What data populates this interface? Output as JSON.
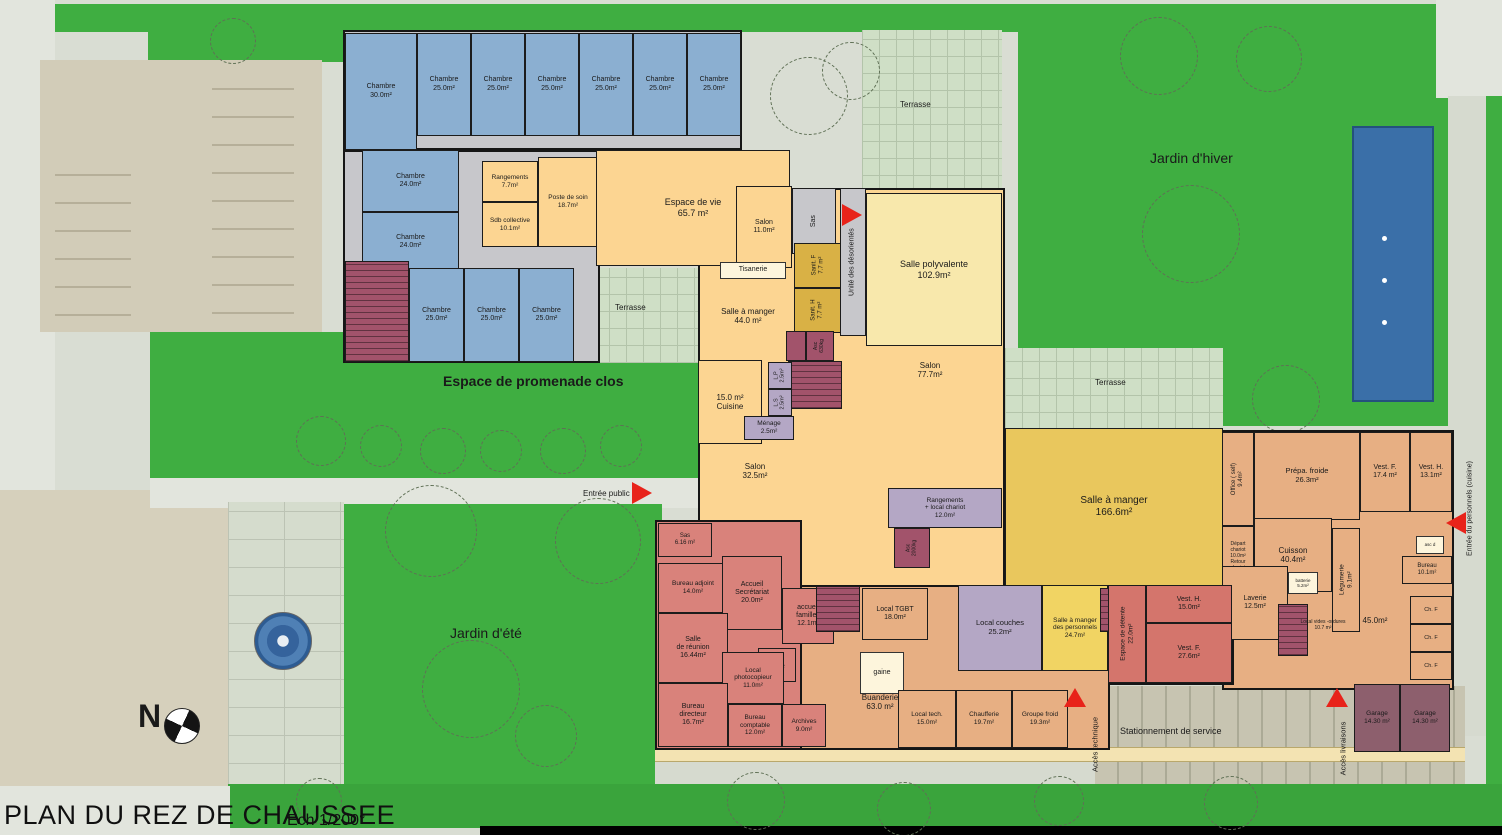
{
  "title": {
    "main": "PLAN DU REZ DE CHAUSSEE",
    "scale": "Ech 1/200°"
  },
  "compass_label": "N",
  "site": {
    "terrasse_top": "Terrasse",
    "jardin_hiver": "Jardin d'hiver",
    "terrasse_north": "Terrasse",
    "espace_promenade": "Espace de promenade clos",
    "entree_public": "Entrée public",
    "jardin_ete": "Jardin d'été",
    "terrasse_mid": "Terrasse",
    "stationnement": "Stationnement de service",
    "acces_technique": "Accès technique",
    "acces_livraisons": "Accès livraisons",
    "entree_personnel": "Entrée du personnels (cuisine)"
  },
  "rooms": [
    {
      "l": "Chambre\n30.0m²",
      "x": 345,
      "y": 33,
      "w": 72,
      "h": 117,
      "c": "blue",
      "fs": 7
    },
    {
      "l": "Chambre\n25.0m²",
      "x": 417,
      "y": 33,
      "w": 54,
      "h": 103,
      "c": "blue",
      "fs": 7
    },
    {
      "l": "Chambre\n25.0m²",
      "x": 471,
      "y": 33,
      "w": 54,
      "h": 103,
      "c": "blue",
      "fs": 7
    },
    {
      "l": "Chambre\n25.0m²",
      "x": 525,
      "y": 33,
      "w": 54,
      "h": 103,
      "c": "blue",
      "fs": 7
    },
    {
      "l": "Chambre\n25.0m²",
      "x": 579,
      "y": 33,
      "w": 54,
      "h": 103,
      "c": "blue",
      "fs": 7
    },
    {
      "l": "Chambre\n25.0m²",
      "x": 633,
      "y": 33,
      "w": 54,
      "h": 103,
      "c": "blue",
      "fs": 7
    },
    {
      "l": "Chambre\n25.0m²",
      "x": 687,
      "y": 33,
      "w": 54,
      "h": 103,
      "c": "blue",
      "fs": 7
    },
    {
      "l": "Chambre\n24.0m²",
      "x": 362,
      "y": 150,
      "w": 97,
      "h": 62,
      "c": "blue",
      "fs": 7
    },
    {
      "l": "Chambre\n24.0m²",
      "x": 362,
      "y": 212,
      "w": 97,
      "h": 60,
      "c": "blue",
      "fs": 7
    },
    {
      "l": "",
      "x": 345,
      "y": 261,
      "w": 64,
      "h": 101,
      "c": "maroonstair"
    },
    {
      "l": "Chambre\n25.0m²",
      "x": 409,
      "y": 268,
      "w": 55,
      "h": 94,
      "c": "blue",
      "fs": 7
    },
    {
      "l": "Chambre\n25.0m²",
      "x": 464,
      "y": 268,
      "w": 55,
      "h": 94,
      "c": "blue",
      "fs": 7
    },
    {
      "l": "Chambre\n25.0m²",
      "x": 519,
      "y": 268,
      "w": 55,
      "h": 94,
      "c": "blue",
      "fs": 7
    },
    {
      "l": "Rangements\n7.7m²",
      "x": 482,
      "y": 161,
      "w": 56,
      "h": 41,
      "c": "orange",
      "fs": 6.5
    },
    {
      "l": "Sdb collective\n10.1m²",
      "x": 482,
      "y": 202,
      "w": 56,
      "h": 45,
      "c": "orange",
      "fs": 6.5
    },
    {
      "l": "Poste de soin\n18.7m²",
      "x": 538,
      "y": 157,
      "w": 60,
      "h": 90,
      "c": "orange",
      "fs": 6.5
    },
    {
      "l": "Espace de vie\n65.7 m²",
      "x": 596,
      "y": 150,
      "w": 194,
      "h": 116,
      "c": "orange",
      "fs": 9
    },
    {
      "l": "Salon\n11.0m²",
      "x": 736,
      "y": 186,
      "w": 56,
      "h": 82,
      "c": "orange",
      "fs": 7
    },
    {
      "l": "Sas",
      "x": 792,
      "y": 188,
      "w": 44,
      "h": 66,
      "c": "grey",
      "rot": 1,
      "fs": 7
    },
    {
      "l": "Sanit. F\n7.7 m²",
      "x": 794,
      "y": 243,
      "w": 48,
      "h": 45,
      "c": "sanit",
      "rot": 1,
      "fs": 6
    },
    {
      "l": "Sanit. H\n7.7 m²",
      "x": 794,
      "y": 288,
      "w": 48,
      "h": 45,
      "c": "sanit",
      "rot": 1,
      "fs": 6
    },
    {
      "l": "Unité des désorientés",
      "x": 840,
      "y": 188,
      "w": 26,
      "h": 148,
      "c": "grey",
      "rot": 1,
      "fs": 7
    },
    {
      "l": "Salle polyvalente\n102.9m²",
      "x": 866,
      "y": 193,
      "w": 136,
      "h": 153,
      "c": "paleyellow",
      "fs": 9
    },
    {
      "l": "Tisanerie",
      "x": 720,
      "y": 262,
      "w": 66,
      "h": 17,
      "c": "box",
      "fs": 7
    },
    {
      "l": "Salle à manger\n44.0 m²",
      "x": 692,
      "y": 296,
      "w": 112,
      "h": 40,
      "c": "none",
      "fs": 8
    },
    {
      "l": "",
      "x": 786,
      "y": 331,
      "w": 20,
      "h": 30,
      "c": "maroon"
    },
    {
      "l": "Asc\n630kg",
      "x": 806,
      "y": 331,
      "w": 28,
      "h": 30,
      "c": "maroon",
      "rot": 1,
      "fs": 5
    },
    {
      "l": "",
      "x": 788,
      "y": 361,
      "w": 54,
      "h": 48,
      "c": "maroonstair"
    },
    {
      "l": "15.0 m²\nCuisine",
      "x": 698,
      "y": 360,
      "w": 64,
      "h": 84,
      "c": "orange",
      "fs": 8
    },
    {
      "l": "L.P\n2.5m²",
      "x": 768,
      "y": 362,
      "w": 24,
      "h": 27,
      "c": "lav",
      "rot": 1,
      "fs": 5.5
    },
    {
      "l": "L.S\n2.5m²",
      "x": 768,
      "y": 389,
      "w": 24,
      "h": 27,
      "c": "lav",
      "rot": 1,
      "fs": 5.5
    },
    {
      "l": "Ménage\n2.5m²",
      "x": 744,
      "y": 416,
      "w": 50,
      "h": 24,
      "c": "lav",
      "fs": 6.5
    },
    {
      "l": "Salon\n32.5m²",
      "x": 718,
      "y": 455,
      "w": 74,
      "h": 32,
      "c": "none",
      "fs": 8
    },
    {
      "l": "Salon\n77.7m²",
      "x": 890,
      "y": 352,
      "w": 80,
      "h": 36,
      "c": "none",
      "fs": 8
    },
    {
      "l": "Rangements\n+ local chariot\n12.0m²",
      "x": 888,
      "y": 488,
      "w": 114,
      "h": 40,
      "c": "lav",
      "fs": 6.5
    },
    {
      "l": "Asc\n2000kg",
      "x": 894,
      "y": 528,
      "w": 36,
      "h": 40,
      "c": "maroon",
      "rot": 1,
      "fs": 5
    },
    {
      "l": "Salle à manger\n166.6m²",
      "x": 1005,
      "y": 428,
      "w": 218,
      "h": 158,
      "c": "gold",
      "fs": 10
    },
    {
      "l": "Office ( self)\n9.4m²",
      "x": 1222,
      "y": 432,
      "w": 32,
      "h": 94,
      "c": "tan",
      "rot": 1,
      "fs": 6
    },
    {
      "l": "Prépa. froide\n26.3m²",
      "x": 1254,
      "y": 432,
      "w": 106,
      "h": 88,
      "c": "tan",
      "fs": 7.5
    },
    {
      "l": "Vest. F.\n17.4 m²",
      "x": 1360,
      "y": 432,
      "w": 50,
      "h": 80,
      "c": "tan",
      "fs": 7
    },
    {
      "l": "Vest. H.\n13.1m²",
      "x": 1410,
      "y": 432,
      "w": 42,
      "h": 80,
      "c": "tan",
      "fs": 7
    },
    {
      "l": "Départ\nchariot\n10.0m²\nRetour\nchariot",
      "x": 1222,
      "y": 526,
      "w": 32,
      "h": 62,
      "c": "tan",
      "fs": 5
    },
    {
      "l": "Cuisson\n40.4m²",
      "x": 1254,
      "y": 518,
      "w": 78,
      "h": 74,
      "c": "tan",
      "fs": 8
    },
    {
      "l": "Légumerie\n9.1m²",
      "x": 1332,
      "y": 528,
      "w": 28,
      "h": 104,
      "c": "tan",
      "rot": 1,
      "fs": 6.5
    },
    {
      "l": "Laverie\n12.5m²",
      "x": 1222,
      "y": 566,
      "w": 66,
      "h": 74,
      "c": "tan",
      "fs": 7
    },
    {
      "l": "batterie\n5.2m²",
      "x": 1288,
      "y": 572,
      "w": 30,
      "h": 22,
      "c": "box",
      "fs": 4.5
    },
    {
      "l": "asc d",
      "x": 1416,
      "y": 536,
      "w": 28,
      "h": 18,
      "c": "box",
      "fs": 4.5
    },
    {
      "l": "Bureau\n10.1m²",
      "x": 1402,
      "y": 556,
      "w": 50,
      "h": 28,
      "c": "tan",
      "fs": 6
    },
    {
      "l": "",
      "x": 1278,
      "y": 604,
      "w": 30,
      "h": 52,
      "c": "maroonstair"
    },
    {
      "l": "Local vides -ordures\n10.7 m²",
      "x": 1290,
      "y": 614,
      "w": 66,
      "h": 24,
      "c": "none",
      "fs": 5
    },
    {
      "l": "45.0m²",
      "x": 1345,
      "y": 608,
      "w": 60,
      "h": 26,
      "c": "none",
      "fs": 8
    },
    {
      "l": "Ch. F",
      "x": 1410,
      "y": 596,
      "w": 42,
      "h": 28,
      "c": "tan",
      "fs": 5.5
    },
    {
      "l": "Ch. F",
      "x": 1410,
      "y": 624,
      "w": 42,
      "h": 28,
      "c": "tan",
      "fs": 5.5
    },
    {
      "l": "Ch. F",
      "x": 1410,
      "y": 652,
      "w": 42,
      "h": 28,
      "c": "tan",
      "fs": 5.5
    },
    {
      "l": "Local couches\n25.2m²",
      "x": 958,
      "y": 585,
      "w": 84,
      "h": 86,
      "c": "lav",
      "fs": 7.5
    },
    {
      "l": "Salle à manger\ndes personnels\n24.7m²",
      "x": 1042,
      "y": 585,
      "w": 66,
      "h": 86,
      "c": "yellow",
      "fs": 6.5
    },
    {
      "l": "",
      "x": 1100,
      "y": 588,
      "w": 14,
      "h": 44,
      "c": "maroonstair"
    },
    {
      "l": "Espace de détente\n22.0m²",
      "x": 1108,
      "y": 585,
      "w": 38,
      "h": 98,
      "c": "red",
      "rot": 1,
      "fs": 6.5
    },
    {
      "l": "Vest. H.\n15.0m²",
      "x": 1146,
      "y": 585,
      "w": 86,
      "h": 38,
      "c": "red",
      "fs": 7
    },
    {
      "l": "Vest. F.\n27.6m²",
      "x": 1146,
      "y": 623,
      "w": 86,
      "h": 60,
      "c": "red",
      "fs": 7
    },
    {
      "l": "Sas\n6.16 m²",
      "x": 658,
      "y": 523,
      "w": 54,
      "h": 34,
      "c": "pink",
      "fs": 6
    },
    {
      "l": "Bureau adjoint\n14.0m²",
      "x": 658,
      "y": 563,
      "w": 70,
      "h": 50,
      "c": "pink",
      "fs": 6.5
    },
    {
      "l": "Accueil\nSecrétariat\n20.0m²",
      "x": 722,
      "y": 556,
      "w": 60,
      "h": 74,
      "c": "pink",
      "fs": 7
    },
    {
      "l": "accueil\nfamilles\n12.1m²",
      "x": 782,
      "y": 588,
      "w": 52,
      "h": 56,
      "c": "pink",
      "fs": 7
    },
    {
      "l": "",
      "x": 816,
      "y": 586,
      "w": 44,
      "h": 46,
      "c": "maroonstair"
    },
    {
      "l": "Local TGBT\n18.0m²",
      "x": 862,
      "y": 588,
      "w": 66,
      "h": 52,
      "c": "tan",
      "fs": 7
    },
    {
      "l": "Salle\nde réunion\n16.44m²",
      "x": 658,
      "y": 613,
      "w": 70,
      "h": 70,
      "c": "pink",
      "fs": 7
    },
    {
      "l": "sanit.\n8.0m²",
      "x": 758,
      "y": 648,
      "w": 38,
      "h": 34,
      "c": "pink",
      "fs": 6
    },
    {
      "l": "Local\nphotocopieur\n11.0m²",
      "x": 722,
      "y": 652,
      "w": 62,
      "h": 52,
      "c": "pink",
      "fs": 6.5
    },
    {
      "l": "gaine",
      "x": 860,
      "y": 652,
      "w": 44,
      "h": 42,
      "c": "box",
      "fs": 7
    },
    {
      "l": "Buanderie\n63.0 m²",
      "x": 820,
      "y": 682,
      "w": 120,
      "h": 40,
      "c": "none",
      "fs": 8
    },
    {
      "l": "Bureau\ndirecteur\n16.7m²",
      "x": 658,
      "y": 683,
      "w": 70,
      "h": 64,
      "c": "pink",
      "fs": 7
    },
    {
      "l": "Bureau\ncomptable\n12.0m²",
      "x": 728,
      "y": 704,
      "w": 54,
      "h": 43,
      "c": "pink",
      "fs": 6.5
    },
    {
      "l": "Archives\n9.0m²",
      "x": 782,
      "y": 704,
      "w": 44,
      "h": 43,
      "c": "pink",
      "fs": 6.5
    },
    {
      "l": "Local tech.\n15.0m²",
      "x": 898,
      "y": 690,
      "w": 58,
      "h": 58,
      "c": "tan",
      "fs": 6.5
    },
    {
      "l": "Chaufferie\n19.7m²",
      "x": 956,
      "y": 690,
      "w": 56,
      "h": 58,
      "c": "tan",
      "fs": 6.5
    },
    {
      "l": "Groupe froid\n19.3m²",
      "x": 1012,
      "y": 690,
      "w": 56,
      "h": 58,
      "c": "tan",
      "fs": 6.5
    },
    {
      "l": "Garage\n14.30 m²",
      "x": 1354,
      "y": 684,
      "w": 46,
      "h": 68,
      "c": "garage",
      "fs": 6.5
    },
    {
      "l": "Garage\n14.30 m²",
      "x": 1400,
      "y": 684,
      "w": 50,
      "h": 68,
      "c": "garage",
      "fs": 6.5
    }
  ]
}
